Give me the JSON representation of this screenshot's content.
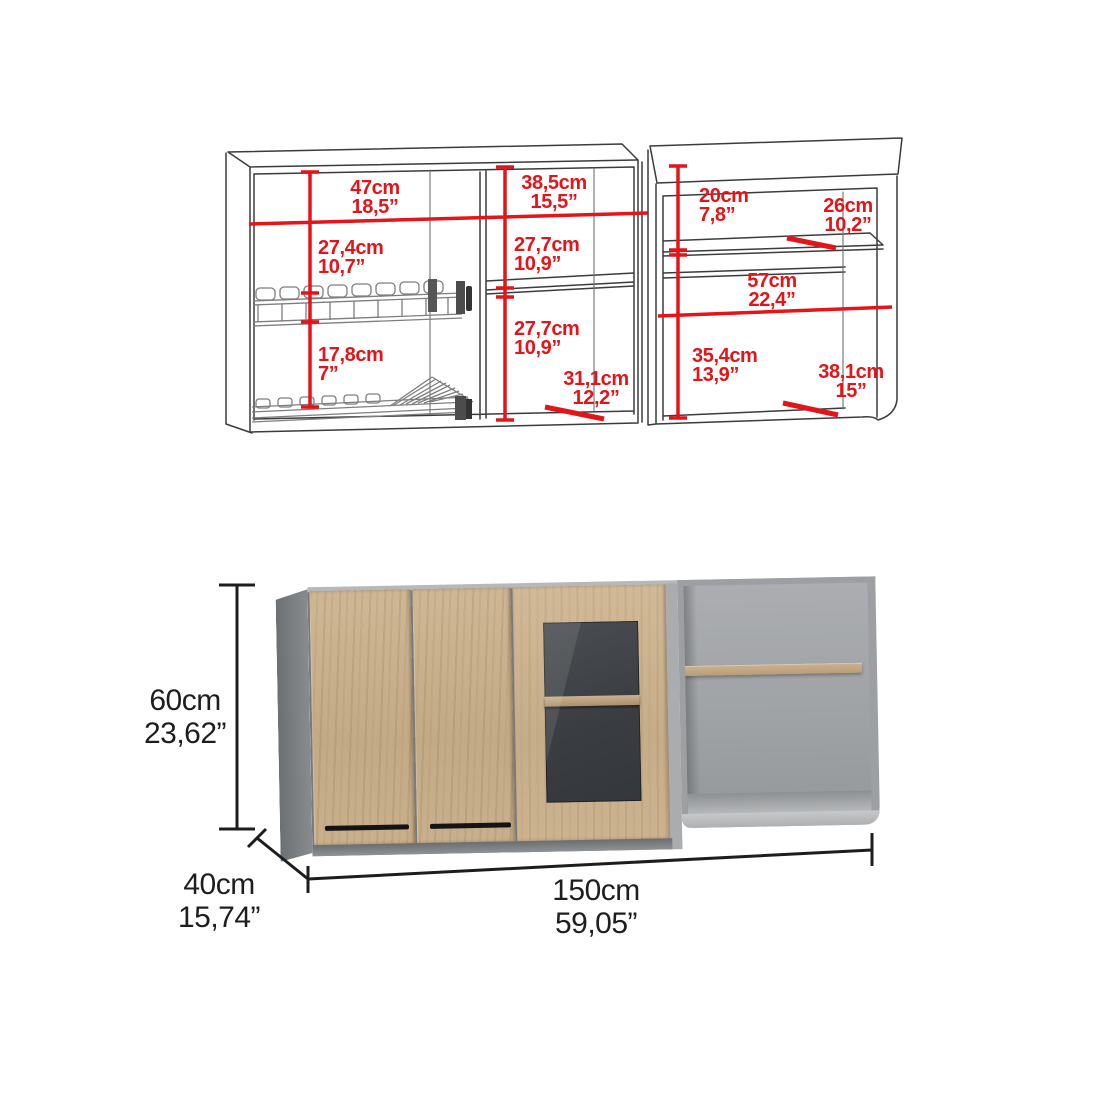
{
  "page": {
    "type": "product-dimension-diagram",
    "background": "#ffffff"
  },
  "wireframe_diagram": {
    "left_cabinet": {
      "interior_width": {
        "cm": "47cm",
        "inch": "18,5”"
      },
      "top_to_rack_height": {
        "cm": "27,4cm",
        "inch": "10,7”"
      },
      "rack_to_rack_height": {
        "cm": "17,8cm",
        "inch": "7”"
      }
    },
    "middle_section": {
      "interior_width": {
        "cm": "38,5cm",
        "inch": "15,5”"
      },
      "upper_shelf_height": {
        "cm": "27,7cm",
        "inch": "10,9”"
      },
      "lower_shelf_height": {
        "cm": "27,7cm",
        "inch": "10,9”"
      },
      "shelf_depth": {
        "cm": "31,1cm",
        "inch": "12,2”"
      }
    },
    "right_cabinet": {
      "top_to_shelf_height": {
        "cm": "20cm",
        "inch": "7,8”"
      },
      "shelf_depth": {
        "cm": "26cm",
        "inch": "10,2”"
      },
      "interior_width": {
        "cm": "57cm",
        "inch": "22,4”"
      },
      "shelf_to_bottom_height": {
        "cm": "35,4cm",
        "inch": "13,9”"
      },
      "bottom_depth": {
        "cm": "38,1cm",
        "inch": "15”"
      }
    }
  },
  "product_view": {
    "height": {
      "cm": "60cm",
      "inch": "23,62”"
    },
    "depth": {
      "cm": "40cm",
      "inch": "15,74”"
    },
    "width": {
      "cm": "150cm",
      "inch": "59,05”"
    }
  },
  "colors": {
    "dimension_red": "#e41418",
    "dimension_black": "#1e1e1e",
    "wireframe_line": "#3c3c3c",
    "wood": "#c7ae8c",
    "carcass_gray": "#9da0a3",
    "interior_dark": "#3f4246",
    "handle_black": "#141414"
  }
}
